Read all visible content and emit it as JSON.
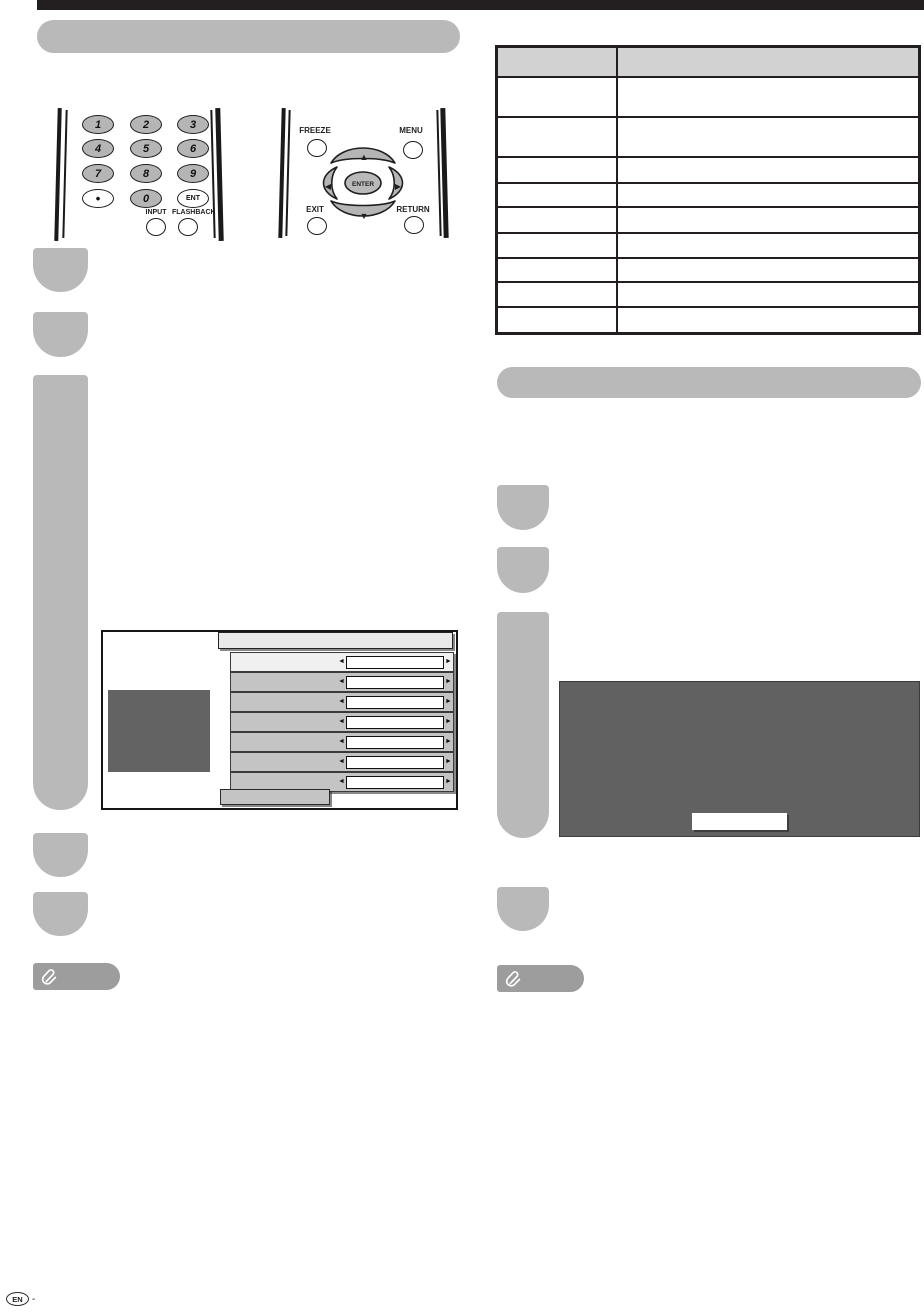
{
  "sections": {
    "left_title": "",
    "right_title": ""
  },
  "remote_left": {
    "keys": [
      "1",
      "2",
      "3",
      "4",
      "5",
      "6",
      "7",
      "8",
      "9"
    ],
    "dot_label": "•",
    "zero_label": "0",
    "ent_label": "ENT",
    "input_label": "INPUT",
    "flashback_label": "FLASHBACK"
  },
  "remote_right": {
    "freeze_label": "FREEZE",
    "menu_label": "MENU",
    "exit_label": "EXIT",
    "return_label": "RETURN",
    "enter_label": "ENTER",
    "up_glyph": "▲",
    "down_glyph": "▼",
    "left_glyph": "◀",
    "right_glyph": "▶"
  },
  "table": {
    "header": [
      "",
      ""
    ],
    "rows": [
      [
        "",
        ""
      ],
      [
        "",
        ""
      ],
      [
        "",
        ""
      ],
      [
        "",
        ""
      ],
      [
        "",
        ""
      ],
      [
        "",
        ""
      ],
      [
        "",
        ""
      ],
      [
        "",
        ""
      ],
      [
        "",
        ""
      ]
    ]
  },
  "osd_menu": {
    "title": "",
    "left_arrow": "◄",
    "right_arrow": "►",
    "rows": [
      {
        "label": "",
        "value": ""
      },
      {
        "label": "",
        "value": ""
      },
      {
        "label": "",
        "value": ""
      },
      {
        "label": "",
        "value": ""
      },
      {
        "label": "",
        "value": ""
      },
      {
        "label": "",
        "value": ""
      },
      {
        "label": "",
        "value": ""
      }
    ],
    "footer_button": ""
  },
  "osd_dialog": {
    "button_label": ""
  },
  "notes": {
    "left_label": "",
    "right_label": ""
  },
  "footer": {
    "region_label": "EN",
    "suffix": "-"
  },
  "colors": {
    "top_bar": "#231f20",
    "section_header": "#b9b9b9",
    "step_badge": "#b9b9b9",
    "note_badge": "#9d9d9d",
    "table_header_bg": "#d2d2d2",
    "osd_dark": "#616161",
    "osd_row": "#c4c4c4",
    "osd_row_highlight": "#f0f0f0",
    "remote_key": "#b5b5b5"
  }
}
